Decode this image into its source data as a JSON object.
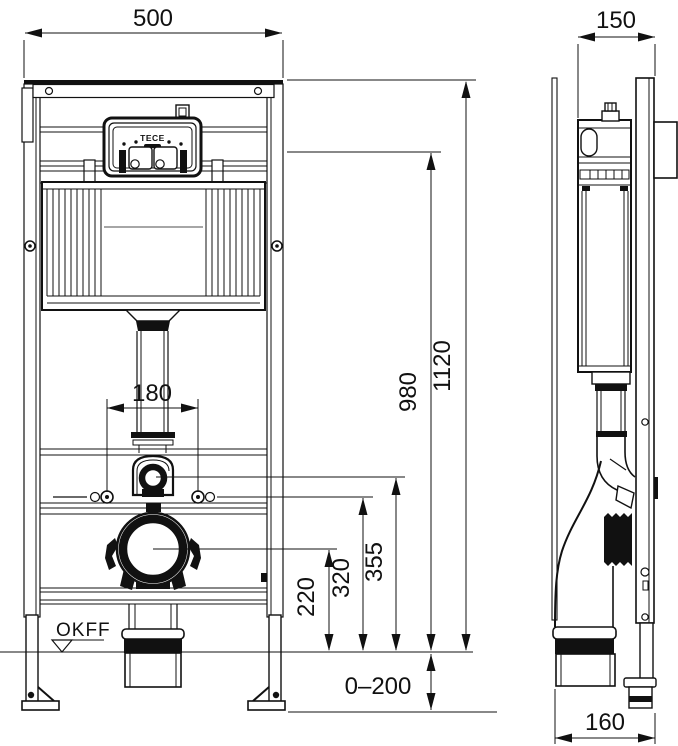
{
  "drawing": {
    "brand": "TECE",
    "floor_label": "OKFF",
    "dims": {
      "frame_width": "500",
      "frame_depth": "150",
      "fixing_spacing": "180",
      "flush_unit_height": "980",
      "total_height": "1120",
      "supply_height": "355",
      "fixing_height": "320",
      "outlet_height": "220",
      "floor_buildup_range": "0–200",
      "outlet_offset": "160"
    }
  }
}
